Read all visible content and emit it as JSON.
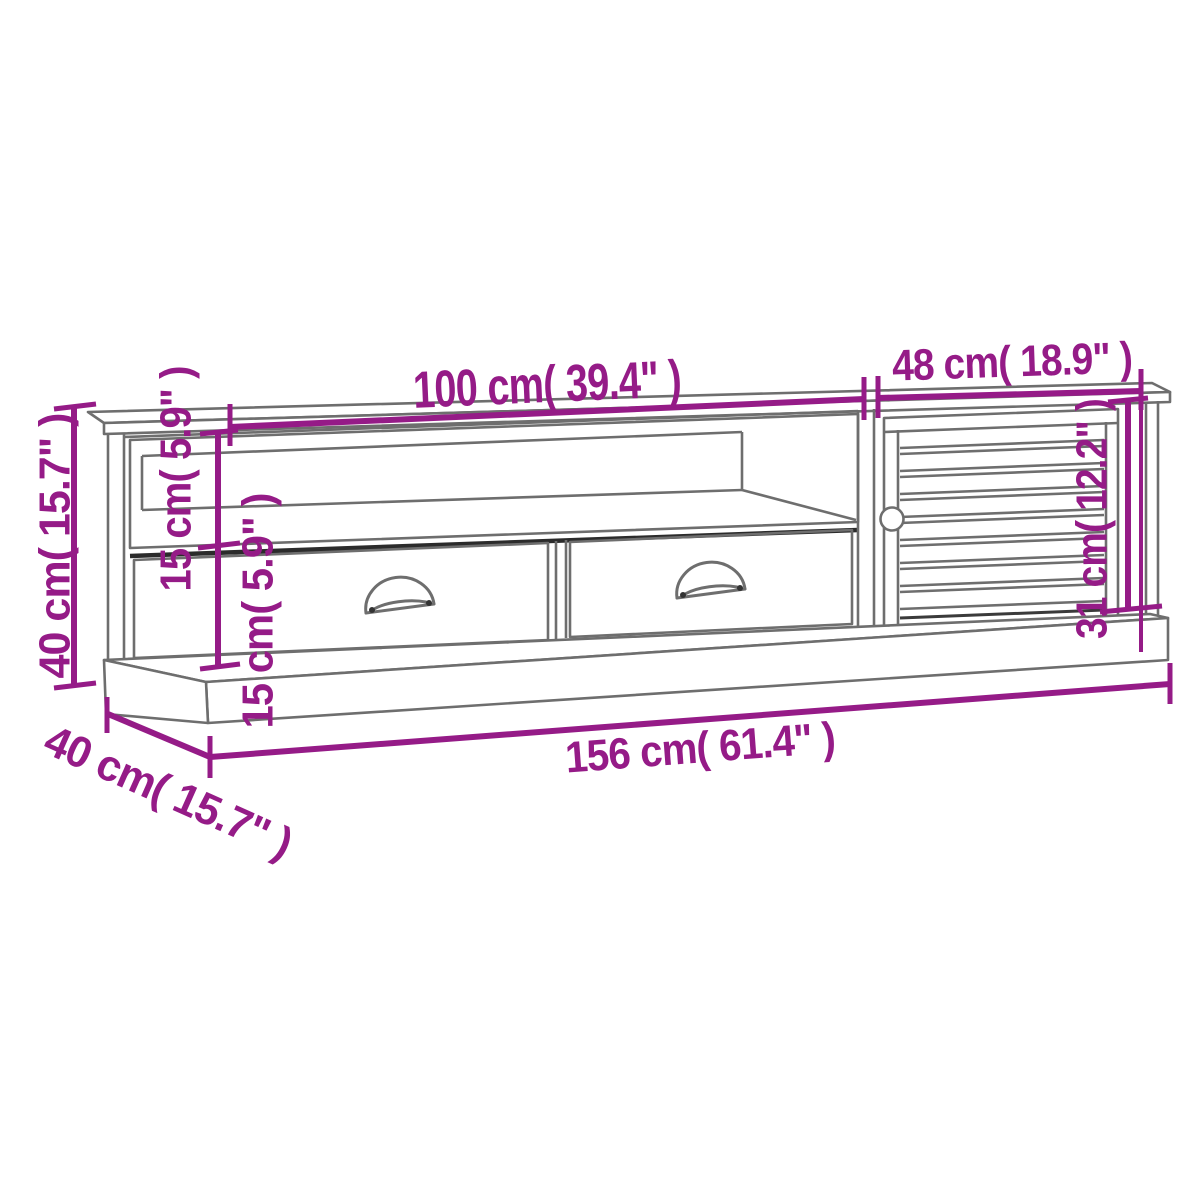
{
  "labels": {
    "width_top": "100 cm( 39.4\" )",
    "width_door": "48 cm( 18.9\" )",
    "height_total": "40 cm( 15.7\" )",
    "height_shelf": "15 cm( 5.9\" )",
    "height_drawer": "15 cm( 5.9\" )",
    "height_door": "31 cm( 12.2\" )",
    "width_total": "156 cm( 61.4\" )",
    "depth_total": "40 cm( 15.7\" )"
  },
  "colors": {
    "dimension": "#951b87",
    "outline": "#6e6e6e",
    "shadow": "#2b2b2b",
    "background": "#ffffff"
  }
}
